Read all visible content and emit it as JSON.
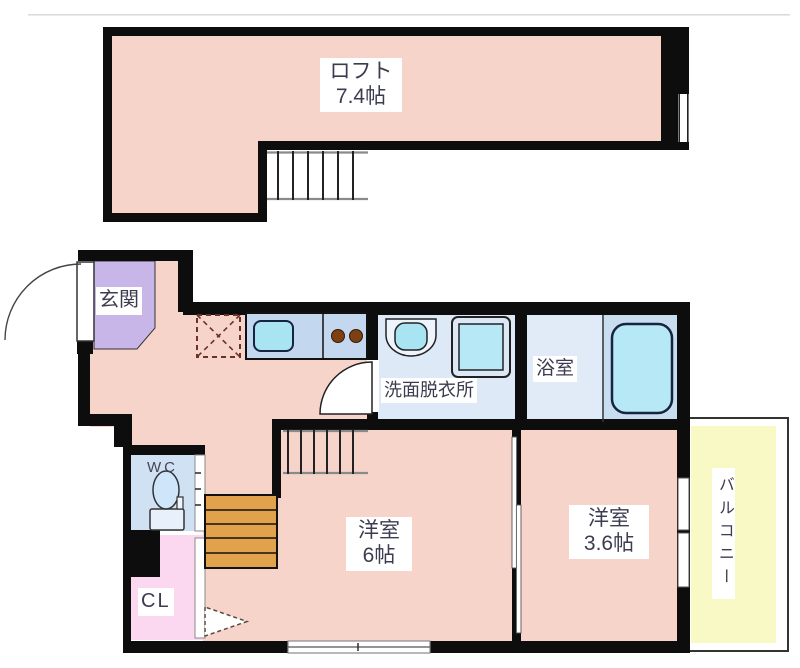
{
  "palette": {
    "room_pink": "#f7d4c9",
    "entry_purple": "#c8b6e9",
    "light_pink": "#fbd8ef",
    "wc_blue": "#cfe1f3",
    "washroom_blue": "#dde9f7",
    "bath_left_blue": "#e1ebf7",
    "bath_right_blue": "#c9ddf1",
    "counter_blue": "#c3d7ee",
    "fixture_cyan": "#a9e4f2",
    "tub_cyan": "#b7e8f6",
    "stairs_tan": "#e2a24b",
    "balcony_yellow": "#f9f9c6",
    "wall_black": "#0d0d0d",
    "label_text": "#3c3c50"
  },
  "loft": {
    "name": "ロフト",
    "area": "7.4帖"
  },
  "floor1": {
    "entrance": "玄関",
    "washroom": "洗面脱衣所",
    "bath": "浴室",
    "wc": "WC",
    "closet": "CL",
    "room6": {
      "name": "洋室",
      "area": "6帖"
    },
    "room36": {
      "name": "洋室",
      "area": "3.6帖"
    },
    "balcony": "バルコニー"
  }
}
